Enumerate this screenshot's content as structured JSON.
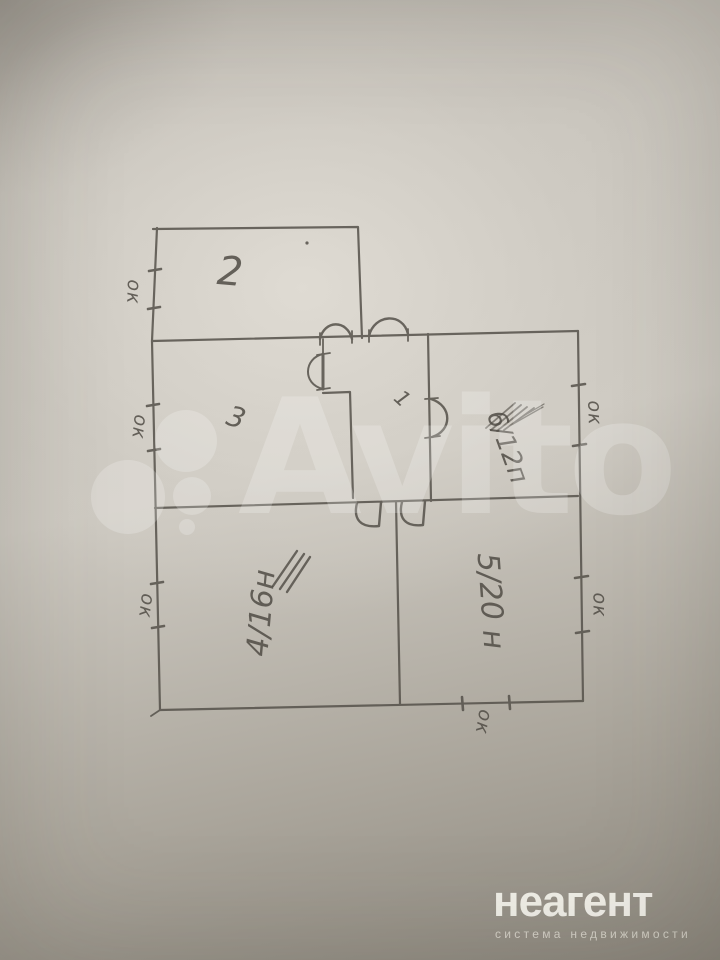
{
  "floor_plan": {
    "rooms": [
      {
        "id": "room-2",
        "label": "2"
      },
      {
        "id": "room-3",
        "label": "3"
      },
      {
        "id": "room-1",
        "label": "1"
      },
      {
        "id": "room-6",
        "label": "6/12п"
      },
      {
        "id": "room-5",
        "label": "5/20 н"
      },
      {
        "id": "room-4",
        "label": "4/16н"
      }
    ],
    "window_marks": [
      {
        "label": "ок"
      },
      {
        "label": "ок"
      },
      {
        "label": "ок"
      },
      {
        "label": "ок"
      },
      {
        "label": "ок"
      },
      {
        "label": "ок"
      }
    ]
  },
  "watermark": {
    "text": "Avito"
  },
  "branding": {
    "title": "неагент",
    "subtitle": "система недвижимости"
  },
  "colors": {
    "paper_light": "#cfcbc3",
    "paper_dark": "#8d887e",
    "pencil": "#55514a",
    "watermark_white": "#ffffff",
    "logo_text": "#f6f4ed"
  }
}
